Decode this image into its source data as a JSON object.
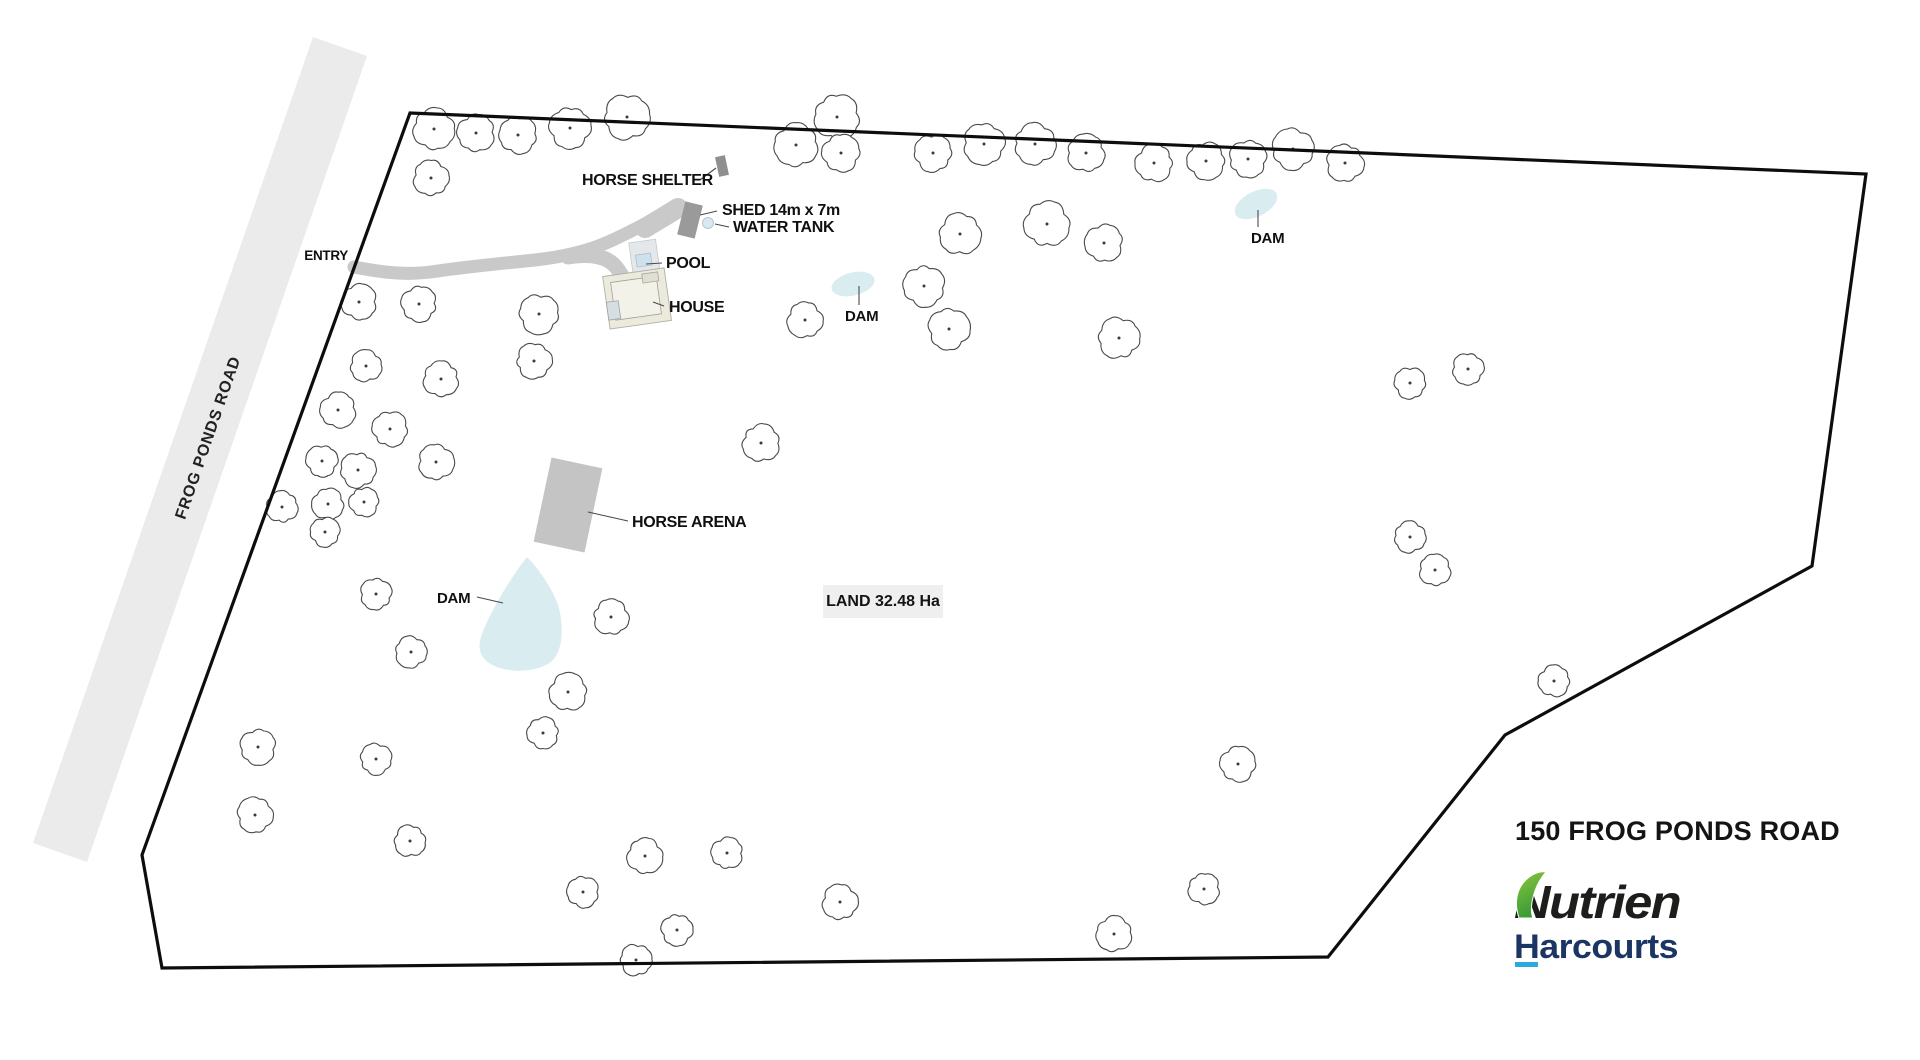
{
  "title": "150 FROG PONDS ROAD",
  "road": {
    "name": "FROG PONDS ROAD"
  },
  "land": {
    "area_label": "LAND 32.48 Ha"
  },
  "labels": {
    "entry": "ENTRY",
    "horse_shelter": "HORSE SHELTER",
    "shed": "SHED 14m x 7m",
    "water_tank": "WATER TANK",
    "pool": "POOL",
    "house": "HOUSE",
    "dam": "DAM",
    "horse_arena": "HORSE ARENA"
  },
  "logo": {
    "brand": "Nutrien",
    "division": "Harcourts",
    "brand_color": "#1d1d1b",
    "division_color": "#1c3664",
    "underline_color": "#2ba9e1",
    "leaf_color_top": "#8cc63f",
    "leaf_color_bottom": "#379a35"
  },
  "colors": {
    "road": "#ebebeb",
    "driveway": "#c9c9c9",
    "water": "#d9edf1",
    "arena": "#c4c4c4",
    "boundary": "#0d0d0d",
    "tree_stroke": "#4a4a4a",
    "leader": "#4a4a4a"
  },
  "map": {
    "boundary_points": "410,113 1866,174 1812,566 1505,735 1328,957 162,968 142,855",
    "under": [
      {
        "n": "road-strip",
        "k": "polygon",
        "pts": "313,37 367,56 87,862 33,843",
        "f": "#ebebeb"
      },
      {
        "n": "driveway-path",
        "k": "path",
        "d": "M354,267 C390,274 412,275 438,271 C465,267 505,263 535,260 C562,257 585,252 606,243 C632,232 660,215 681,206",
        "s": "#c9c9c9",
        "sw": 13,
        "cap": "round"
      },
      {
        "n": "driveway-widening",
        "k": "path",
        "d": "M645,228 C660,219 670,213 678,208",
        "s": "#c9c9c9",
        "sw": 20,
        "cap": "round"
      },
      {
        "n": "driveway-branch",
        "k": "path",
        "d": "M568,257 C592,253 608,257 616,267 C625,278 629,292 630,304",
        "s": "#c9c9c9",
        "sw": 15,
        "cap": "round"
      },
      {
        "n": "dam-shape-west",
        "k": "path",
        "d": "M527,557 C511,577 490,612 482,634 C476,650 481,661 497,667 C516,674 543,671 554,659 C563,648 564,624 558,605 C552,588 539,569 527,557 Z",
        "f": "#d9edf1"
      },
      {
        "n": "dam-shape-middle",
        "k": "ellipse",
        "cx": 853,
        "cy": 284,
        "rx": 22,
        "ry": 11.5,
        "f": "#d9edf1",
        "rot": [
          -14,
          853,
          284
        ]
      },
      {
        "n": "dam-shape-northeast",
        "k": "ellipse",
        "cx": 1256,
        "cy": 204,
        "rx": 23,
        "ry": 12.5,
        "f": "#d9edf1",
        "rot": [
          -27,
          1256,
          204
        ]
      },
      {
        "n": "horse-arena-shape",
        "k": "rect",
        "x": 542,
        "y": 462,
        "w": 52,
        "h": 86,
        "f": "#c4c4c4",
        "rot": [
          12,
          568,
          505
        ]
      }
    ],
    "trees": [
      [
        434,
        129,
        21
      ],
      [
        476,
        133,
        19
      ],
      [
        518,
        135,
        19
      ],
      [
        570,
        128,
        21
      ],
      [
        627,
        117,
        23
      ],
      [
        431,
        178,
        18
      ],
      [
        796,
        145,
        22
      ],
      [
        837,
        117,
        23
      ],
      [
        841,
        153,
        19
      ],
      [
        933,
        153,
        19
      ],
      [
        984,
        144,
        21
      ],
      [
        1035,
        144,
        21
      ],
      [
        1086,
        153,
        19
      ],
      [
        1154,
        163,
        19
      ],
      [
        1206,
        161,
        19
      ],
      [
        1248,
        159,
        19
      ],
      [
        1293,
        149,
        21
      ],
      [
        1345,
        163,
        19
      ],
      [
        960,
        234,
        21
      ],
      [
        1047,
        224,
        23
      ],
      [
        1104,
        243,
        19
      ],
      [
        924,
        286,
        21
      ],
      [
        949,
        329,
        21
      ],
      [
        1119,
        338,
        21
      ],
      [
        805,
        320,
        18
      ],
      [
        761,
        443,
        19
      ],
      [
        359,
        302,
        18
      ],
      [
        419,
        304,
        18
      ],
      [
        539,
        314,
        20
      ],
      [
        534,
        361,
        18
      ],
      [
        366,
        366,
        16
      ],
      [
        441,
        379,
        18
      ],
      [
        338,
        410,
        18
      ],
      [
        390,
        429,
        18
      ],
      [
        322,
        461,
        16
      ],
      [
        358,
        470,
        18
      ],
      [
        436,
        462,
        18
      ],
      [
        282,
        507,
        16
      ],
      [
        328,
        504,
        16
      ],
      [
        364,
        502,
        15
      ],
      [
        325,
        532,
        15
      ],
      [
        376,
        594,
        16
      ],
      [
        411,
        652,
        16
      ],
      [
        611,
        617,
        18
      ],
      [
        568,
        692,
        19
      ],
      [
        543,
        733,
        16
      ],
      [
        258,
        747,
        18
      ],
      [
        376,
        759,
        16
      ],
      [
        255,
        815,
        18
      ],
      [
        410,
        841,
        16
      ],
      [
        645,
        856,
        18
      ],
      [
        727,
        853,
        16
      ],
      [
        583,
        892,
        16
      ],
      [
        677,
        930,
        16
      ],
      [
        636,
        960,
        16
      ],
      [
        840,
        902,
        18
      ],
      [
        1114,
        934,
        18
      ],
      [
        1204,
        889,
        16
      ],
      [
        1238,
        764,
        18
      ],
      [
        1410,
        383,
        16
      ],
      [
        1468,
        369,
        16
      ],
      [
        1410,
        537,
        16
      ],
      [
        1435,
        570,
        16
      ],
      [
        1554,
        681,
        16
      ]
    ],
    "over": [
      {
        "n": "horse-shelter-shape",
        "k": "rect",
        "x": 717,
        "y": 156,
        "w": 10,
        "h": 20,
        "f": "#8f8f8f",
        "rot": [
          -12,
          722,
          166
        ]
      },
      {
        "n": "shed-shape",
        "k": "rect",
        "x": 681,
        "y": 203,
        "w": 18,
        "h": 34,
        "f": "#9a9a9a",
        "rot": [
          14,
          690,
          220
        ]
      },
      {
        "n": "water-tank-shape",
        "k": "circle",
        "cx": 708,
        "cy": 223,
        "r": 5.5,
        "f": "#d9e9f1",
        "s": "#b3c8d4",
        "sw": 1
      },
      {
        "n": "pool-shape",
        "k": "rect",
        "x": 631,
        "y": 241,
        "w": 27,
        "h": 34,
        "f": "#e4e8ea",
        "s": "#c4c9cc",
        "sw": 0.8,
        "rot": [
          -8,
          644,
          258
        ]
      },
      {
        "n": "pool-water-shape",
        "k": "rect",
        "x": 636,
        "y": 254,
        "w": 15,
        "h": 12,
        "f": "#cfe1ec",
        "s": "#a9c0d2",
        "sw": 0.8,
        "rot": [
          -8,
          644,
          258
        ]
      },
      {
        "n": "house-shape",
        "k": "rect",
        "x": 606,
        "y": 272,
        "w": 62,
        "h": 53,
        "f": "#ebeadd",
        "s": "#b0b0a6",
        "sw": 0.9,
        "rot": [
          -8,
          637,
          298
        ]
      },
      {
        "n": "house-inner-shape",
        "k": "rect",
        "x": 613,
        "y": 279,
        "w": 46,
        "h": 38,
        "f": "#f3f2e8",
        "s": "#a39f96",
        "sw": 0.8,
        "rot": [
          -8,
          637,
          298
        ]
      },
      {
        "n": "house-wing-shape",
        "k": "rect",
        "x": 606,
        "y": 298,
        "w": 12,
        "h": 18,
        "f": "#d7dee2",
        "s": "#9aa4aa",
        "sw": 0.8,
        "rot": [
          -8,
          637,
          298
        ]
      },
      {
        "n": "house-porch-shape",
        "k": "rect",
        "x": 645,
        "y": 275,
        "w": 16,
        "h": 9,
        "f": "#dfdfd3",
        "s": "#a8a89e",
        "sw": 0.8,
        "rot": [
          -8,
          637,
          298
        ]
      }
    ],
    "leaders": [
      [
        700,
        180,
        716,
        168
      ],
      [
        717,
        211,
        700,
        215
      ],
      [
        729,
        227,
        715,
        224
      ],
      [
        662,
        263,
        646,
        264
      ],
      [
        664,
        306,
        653,
        302
      ],
      [
        628,
        521,
        588,
        512
      ],
      [
        477,
        597,
        503,
        603
      ],
      [
        859,
        286,
        859,
        305
      ],
      [
        1258,
        210,
        1258,
        227
      ]
    ]
  }
}
